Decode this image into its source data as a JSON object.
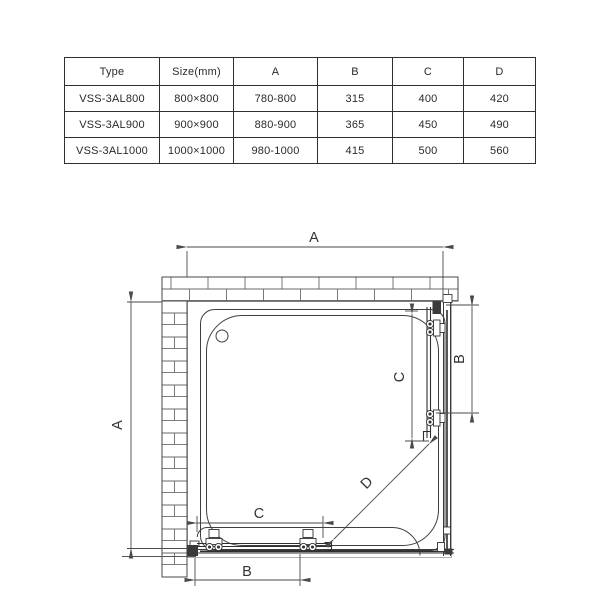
{
  "table": {
    "headers": [
      "Type",
      "Size(mm)",
      "A",
      "B",
      "C",
      "D"
    ],
    "rows": [
      [
        "VSS-3AL800",
        "800×800",
        "780-800",
        "315",
        "400",
        "420"
      ],
      [
        "VSS-3AL900",
        "900×900",
        "880-900",
        "365",
        "450",
        "490"
      ],
      [
        "VSS-3AL1000",
        "1000×1000",
        "980-1000",
        "415",
        "500",
        "560"
      ]
    ]
  },
  "drawing": {
    "labels": {
      "top": "A",
      "left": "A",
      "right_b": "B",
      "right_c": "C",
      "bottom_c": "C",
      "bottom_b": "B",
      "diagonal": "D"
    },
    "colors": {
      "line": "#3a3a3a",
      "dimension": "#4a4a4a",
      "brick": "#6a6a6a",
      "boundary": "#b0b0b0",
      "background": "#ffffff"
    }
  }
}
